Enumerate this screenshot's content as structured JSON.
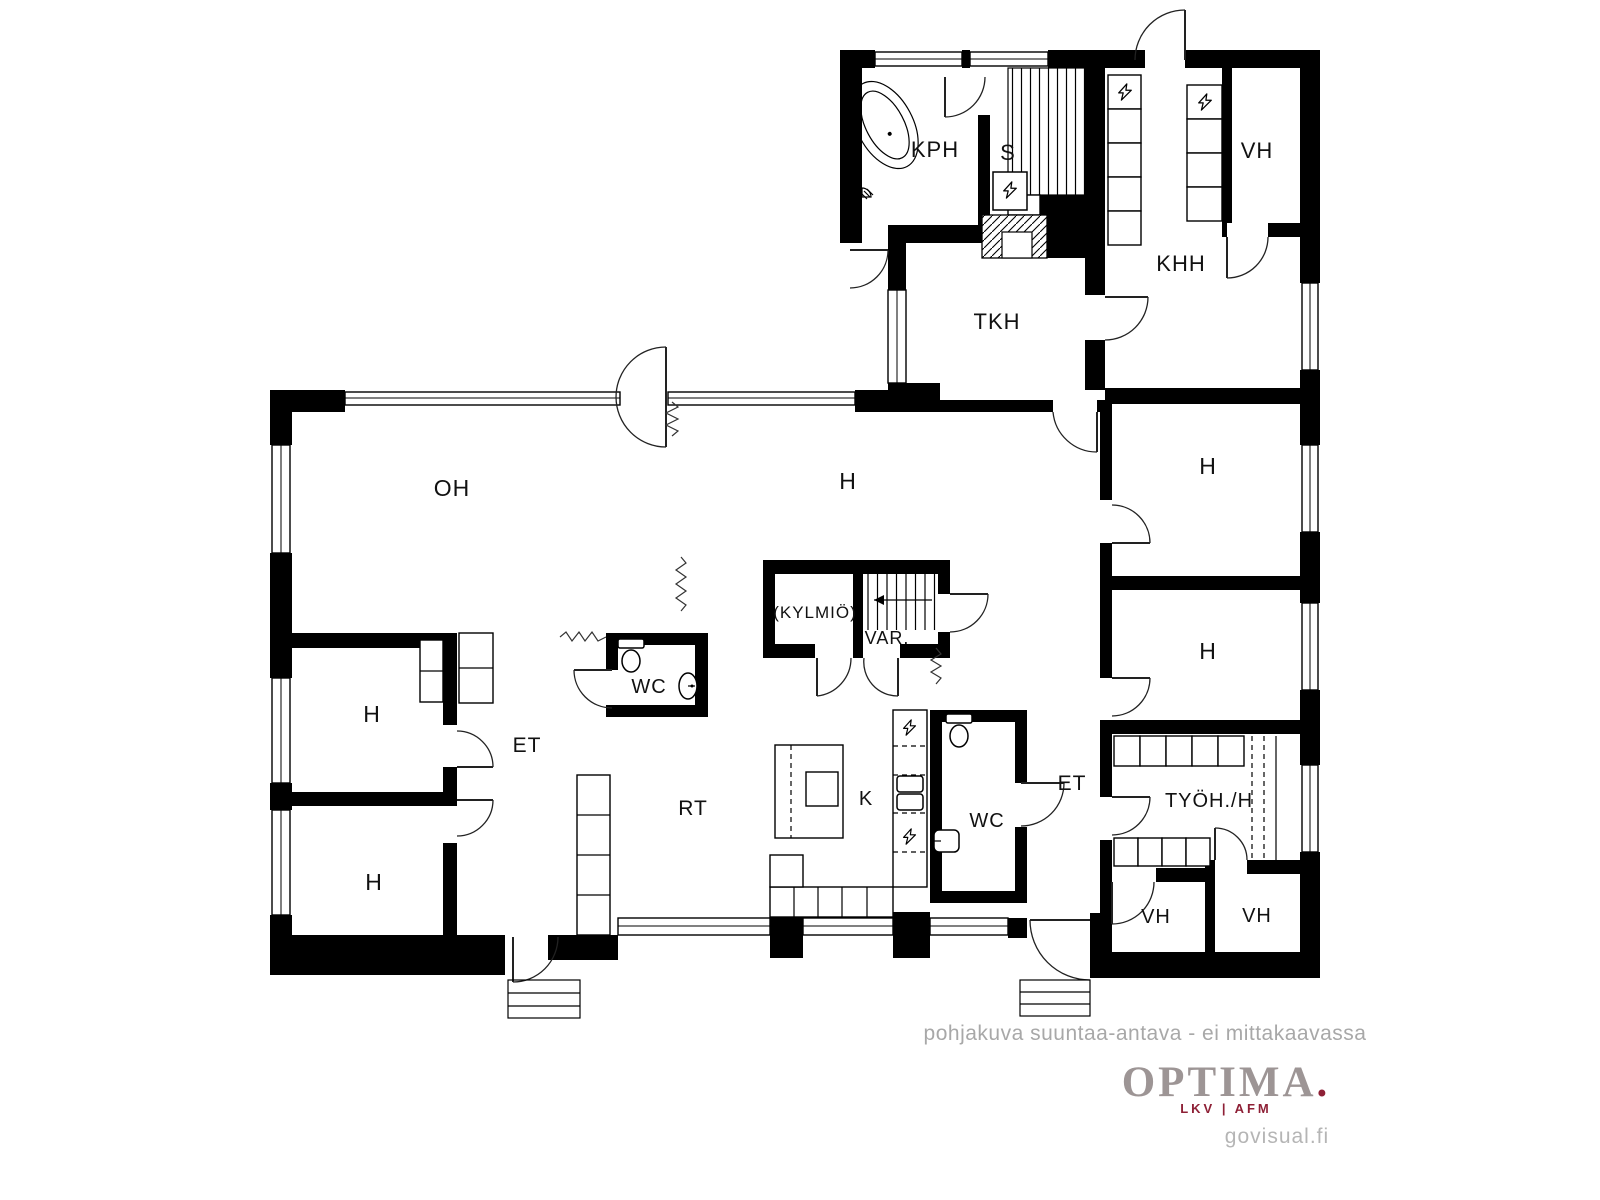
{
  "rooms": {
    "kph": {
      "label": "KPH"
    },
    "s": {
      "label": "S"
    },
    "vh_top": {
      "label": "VH"
    },
    "khh": {
      "label": "KHH"
    },
    "tkh": {
      "label": "TKH"
    },
    "oh": {
      "label": "OH"
    },
    "h_center": {
      "label": "H"
    },
    "h_right_top": {
      "label": "H"
    },
    "h_right_mid": {
      "label": "H"
    },
    "kylmio": {
      "label": "(KYLMIÖ)"
    },
    "var": {
      "label": "VAR."
    },
    "wc_center": {
      "label": "WC"
    },
    "h_left_top": {
      "label": "H"
    },
    "h_left_bottom": {
      "label": "H"
    },
    "et_left": {
      "label": "ET"
    },
    "rt": {
      "label": "RT"
    },
    "k": {
      "label": "K"
    },
    "wc_right": {
      "label": "WC"
    },
    "et_right": {
      "label": "ET"
    },
    "tyoh": {
      "label": "TYÖH./H"
    },
    "vh_bottom_left": {
      "label": "VH"
    },
    "vh_bottom_right": {
      "label": "VH"
    }
  },
  "footer": {
    "disclaimer": "pohjakuva suuntaa-antava - ei mittakaavassa",
    "brand": "OPTIMA",
    "brand_dot": ".",
    "brand_sub": "LKV | AFM",
    "watermark": "govisual.fi"
  },
  "colors": {
    "wall": "#000000",
    "background": "#ffffff",
    "disclaimer_gray": "#a8a8a8",
    "brand_gray": "#9d9595",
    "brand_red": "#8e2036",
    "watermark_gray": "#b5b5b5"
  }
}
